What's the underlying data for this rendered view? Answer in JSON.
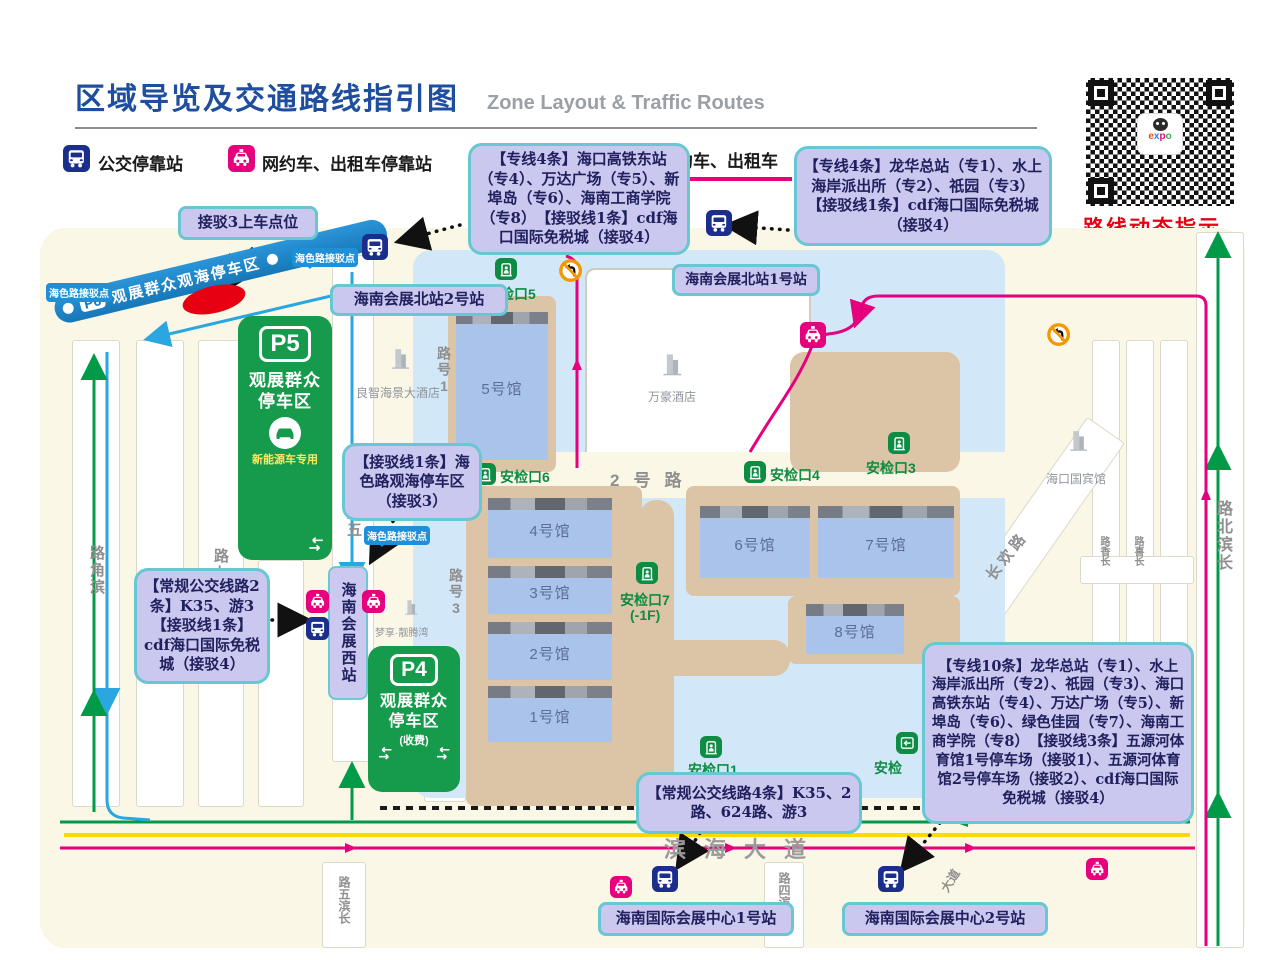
{
  "header": {
    "title": "区域导览及交通路线指引图",
    "subtitle": "Zone Layout & Traffic Routes",
    "legend": {
      "bus": "公交停靠站",
      "taxi": "网约车、出租车停靠站",
      "fragment": "约车、出租车"
    },
    "qr": {
      "caption": "路线动态指示",
      "logo": [
        "e",
        "x",
        "p",
        "o"
      ]
    },
    "compass": "N"
  },
  "callouts": {
    "pickup3": "接驳3上车点位",
    "lines_east4": "【专线4条】海口高铁东站（专4）、万达广场（专5）、新埠岛（专6）、海南工商学院（专8）　【接驳线1条】cdf海口国际免税城（接驳4）",
    "lines_longhua4": "【专线4条】龙华总站（专1）、水上海岸派出所（专2）、祇园（专3）【接驳线1条】cdf海口国际免税城（接驳4）",
    "north_station1": "海南会展北站1号站",
    "north_station2": "海南会展北站2号站",
    "shuttle_haiselu": "【接驳线1条】海色路观海停车区（接驳3）",
    "bus_west2": "【常规公交线路2条】K35、游3 【接驳线1条】cdf海口国际免税城（接驳4）",
    "lines_south10": "【专线10条】龙华总站（专1）、水上海岸派出所（专2）、祇园（专3）、海口高铁东站（专4）、万达广场（专5）、新埠岛（专6）、绿色佳园（专7）、海南工商学院（专8）　【接驳线3条】五源河体育馆1号停车场（接驳1）、五源河体育馆2号停车场（接驳2）、cdf海口国际免税城（接驳4）",
    "bus_south4": "【常规公交线路4条】K35、2路、624路、游3",
    "intl_station1": "海南国际会展中心1号站",
    "intl_station2": "海南国际会展中心2号站"
  },
  "parking": {
    "p6": {
      "code": "P6",
      "name": "观展群众观海停车区"
    },
    "p5": {
      "code": "P5",
      "line1": "观展群众",
      "line2": "停车区",
      "note": "新能源车专用"
    },
    "p4": {
      "code": "P4",
      "line1": "观展群众",
      "line2": "停车区",
      "note": "(收费)"
    }
  },
  "halls": {
    "h1": "1号馆",
    "h2": "2号馆",
    "h3": "3号馆",
    "h4": "4号馆",
    "h5": "5号馆",
    "h6": "6号馆",
    "h7": "7号馆",
    "h8": "8号馆"
  },
  "checkpoints": {
    "cp1": "安检口1",
    "cp2": "安检",
    "cp3": "安检口3",
    "cp4": "安检口4",
    "cp5": "安检口5",
    "cp6": "安检口6",
    "cp7": "安检口7",
    "cp7_floor": "(-1F)"
  },
  "stations": {
    "west": "海南会展西站",
    "shuttle_tag": "海色路接驳点"
  },
  "hotels": {
    "liangzhi": "良智海景大酒店",
    "wanhao": "万豪酒店",
    "guobin": "海口国宾馆",
    "mengxiang": "梦享·靓腾湾"
  },
  "roads": {
    "binjiao": "滨角路",
    "qi": "七路",
    "wu": "五路",
    "no1": "1号路",
    "no2": "2号路",
    "no3": "3号路",
    "changhuan": "长欢路",
    "changxiang": "长香路",
    "changxi": "长喜路",
    "changbinbei": "长滨北路",
    "changbin5": "长滨五路",
    "changbin4": "长滨四路",
    "binhai": "滨海大道",
    "dadao": "大道"
  },
  "colors": {
    "bus_route_blue": "#2aa7e0",
    "taxi_route_pink": "#e6007e",
    "green_route": "#009a49",
    "yellow_route": "#ffd800",
    "walk_dotted": "#1a1a1a",
    "parking_green": "#169a4c",
    "checkpoint_green": "#0e8c43",
    "callout_bg": "#cac8ee",
    "callout_border": "#68c7d2",
    "title_blue": "#1f4e9f",
    "alert_red": "#e60012"
  }
}
